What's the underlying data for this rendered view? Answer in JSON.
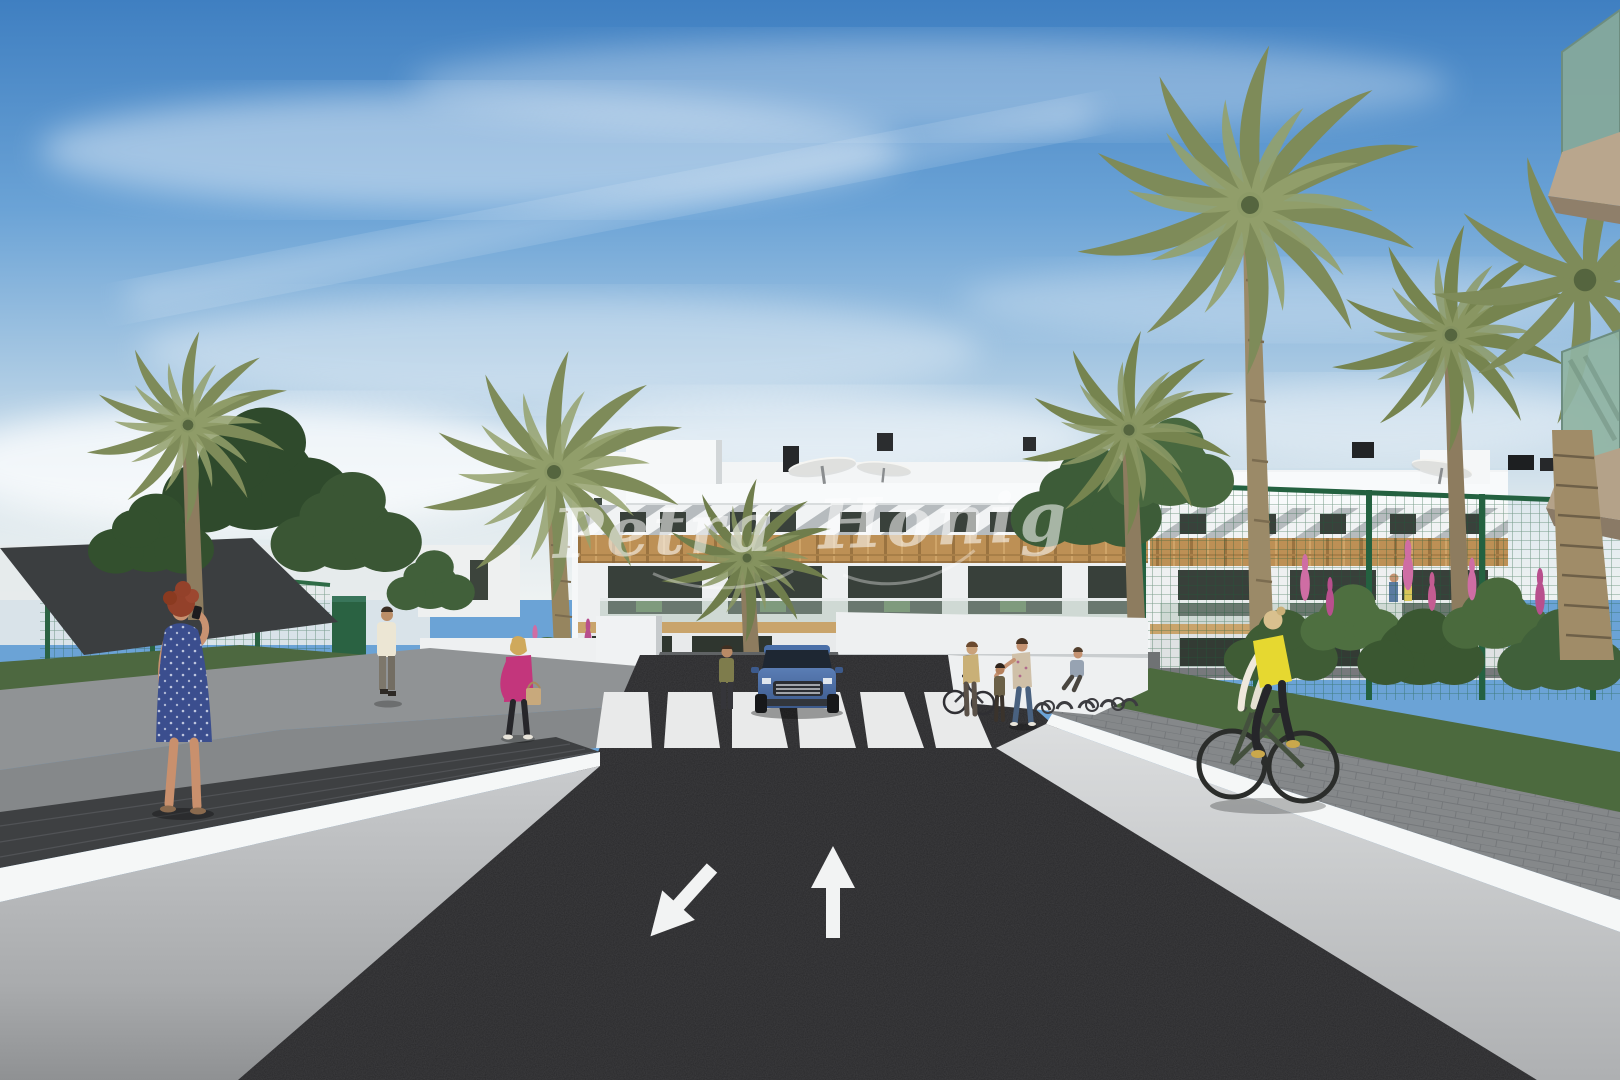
{
  "image": {
    "kind": "3D architectural rendering",
    "subject": "New-build white apartment complex street view with palm trees, garage ramp, crosswalk and pedestrians",
    "watermark": {
      "text": "Petra Honig",
      "color": "#ffffff",
      "style": "semi-transparent handwritten script"
    }
  },
  "palette": {
    "sky_top": "#3f7fc1",
    "sky_mid": "#6ba3d6",
    "sky_horizon": "#e9eff1",
    "asphalt": "#2a2a2c",
    "road_marking": "#f2f3f3",
    "wall_white": "#f5f7f7",
    "wall_shade": "#b9bbbd",
    "facade_white": "#f3f5f6",
    "wood_accent": "#bd9055",
    "window_glass": "#39413b",
    "fence_green": "#2e6b46",
    "palm_green": "#7e8b59",
    "tree_green": "#3d5c38",
    "flower_pink": "#cf6da4",
    "car_blue": "#4a6fa8",
    "vest_yellow": "#e6d830",
    "jacket_pink": "#c3367c",
    "dress_blue": "#3b4e8e",
    "balcony_glass": "#8fb3a2",
    "balcony_slab": "#b4a289"
  },
  "road": {
    "surface": "dark asphalt",
    "lane_arrows": [
      {
        "direction": "down-left",
        "meaning": "lane toward viewer"
      },
      {
        "direction": "up",
        "meaning": "lane away from viewer"
      }
    ],
    "crosswalk_stripes": 6,
    "garage_ramp": "underground parking entrance at end of street with small painted arrows"
  },
  "vehicles": [
    {
      "type": "SUV",
      "color": "#4a6fa8",
      "location": "exiting underground garage ramp, facing viewer"
    }
  ],
  "people": [
    {
      "id": "woman-phone",
      "description": "red-haired woman in blue polka-dot dress talking on phone",
      "location": "left walkway foreground"
    },
    {
      "id": "man-tank-top",
      "description": "man in cream tank top walking near green gate",
      "location": "left walkway middle"
    },
    {
      "id": "woman-pink-jacket",
      "description": "blonde woman in pink jacket carrying tan handbag",
      "location": "left path by flower bed"
    },
    {
      "id": "woman-olive",
      "description": "woman in olive top standing on ramp-side wall",
      "location": "left of garage ramp"
    },
    {
      "id": "woman-bicycle",
      "description": "woman wheeling a bicycle",
      "location": "right of crosswalk"
    },
    {
      "id": "woman-floral-child",
      "description": "woman in floral blouse leaning toward a child",
      "location": "right of crosswalk"
    },
    {
      "id": "woman-seated",
      "description": "seated woman near bike racks",
      "location": "right plaza"
    },
    {
      "id": "cyclist",
      "description": "blonde woman in yellow vest on dark green bicycle",
      "location": "right paver path foreground"
    },
    {
      "id": "balcony-couple",
      "description": "two residents on a first-floor balcony",
      "location": "right wing of building"
    }
  ],
  "building": {
    "floors": 3,
    "style": "white modern flat-roof apartment block",
    "features": [
      "white slatted pergola shading on top floor",
      "horizontal wood cladding band",
      "glass balustrades",
      "roof terraces with white parasols",
      "black roof vents and chimneys",
      "ground-floor terraces with green outdoor furniture",
      "stairwell tower with narrow window"
    ]
  },
  "landscape": {
    "palm_count": 7,
    "shade_sail": "dark canvas sail over left garden",
    "fences": "green mesh security fencing with a green gate",
    "flower_colors": [
      "pink",
      "magenta",
      "orange"
    ],
    "paths": "grey paver walkways flanking the road with white retaining walls"
  },
  "foreground_right": {
    "balconies": 2,
    "balustrade": "green tinted glass",
    "slab_color": "#b4a289"
  }
}
